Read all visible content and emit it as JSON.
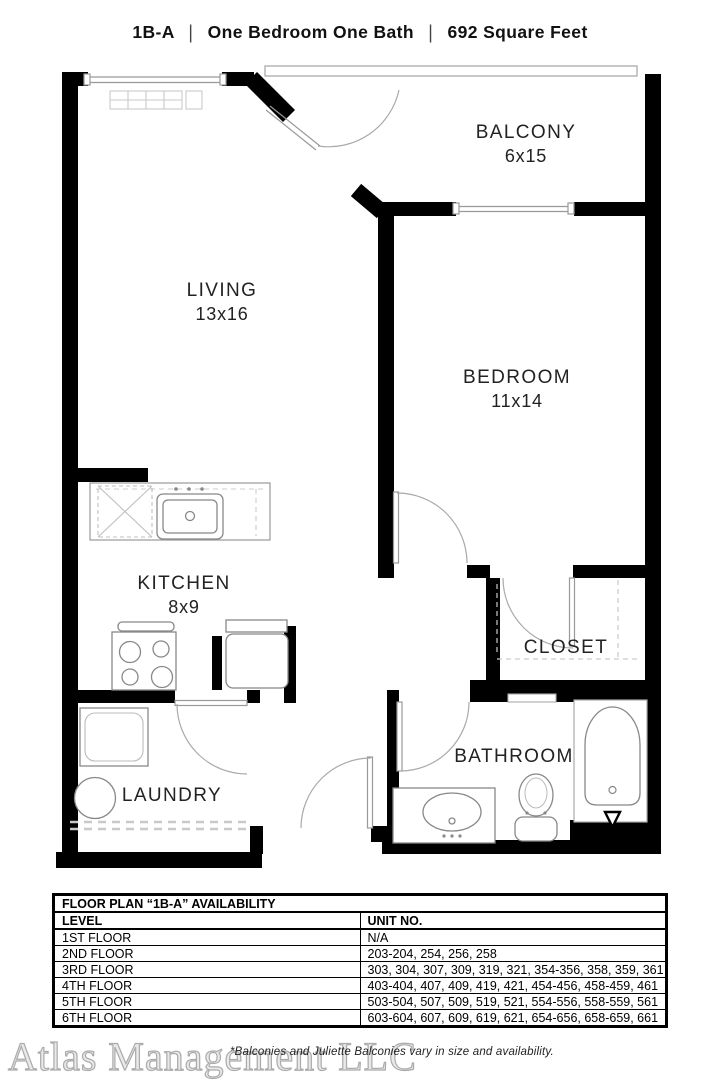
{
  "title": {
    "plan_code": "1B-A",
    "separator": "|",
    "unit_type": "One Bedroom One Bath",
    "square_feet": "692 Square Feet"
  },
  "rooms": {
    "living": {
      "name": "LIVING",
      "dims": "13x16"
    },
    "balcony": {
      "name": "BALCONY",
      "dims": "6x15"
    },
    "bedroom": {
      "name": "BEDROOM",
      "dims": "11x14"
    },
    "kitchen": {
      "name": "KITCHEN",
      "dims": "8x9"
    },
    "closet": {
      "name": "CLOSET"
    },
    "bathroom": {
      "name": "BATHROOM"
    },
    "laundry": {
      "name": "LAUNDRY"
    }
  },
  "fixtures": [
    "entry-balcony-door",
    "living-window",
    "baseboard-heater",
    "balcony-railing",
    "bedroom-window",
    "bedroom-door",
    "closet-door",
    "bathroom-door",
    "laundry-door",
    "hall-door",
    "kitchen-sink",
    "dishwasher",
    "stove",
    "refrigerator",
    "washer",
    "utility-tub",
    "vanity-sink",
    "toilet",
    "bathtub"
  ],
  "availability": {
    "table_title": "FLOOR PLAN “1B-A” AVAILABILITY",
    "col_level": "LEVEL",
    "col_units": "UNIT NO.",
    "rows": [
      {
        "level": "1ST FLOOR",
        "units": "N/A"
      },
      {
        "level": "2ND FLOOR",
        "units": "203-204, 254, 256, 258"
      },
      {
        "level": "3RD FLOOR",
        "units": "303, 304, 307, 309, 319, 321, 354-356, 358, 359, 361"
      },
      {
        "level": "4TH FLOOR",
        "units": "403-404, 407, 409, 419, 421, 454-456, 458-459, 461"
      },
      {
        "level": "5TH FLOOR",
        "units": "503-504, 507, 509, 519, 521, 554-556, 558-559, 561"
      },
      {
        "level": "6TH FLOOR",
        "units": "603-604, 607, 609, 619, 621, 654-656, 658-659, 661"
      }
    ]
  },
  "footer": {
    "watermark": "Atlas Management LLC",
    "note": "*Balconies and Juliette Balconies vary in size and availability."
  },
  "colors": {
    "wall": "#000000",
    "fixture_line": "#8a8a8a",
    "light_line": "#c9c9c9",
    "text": "#222222"
  }
}
